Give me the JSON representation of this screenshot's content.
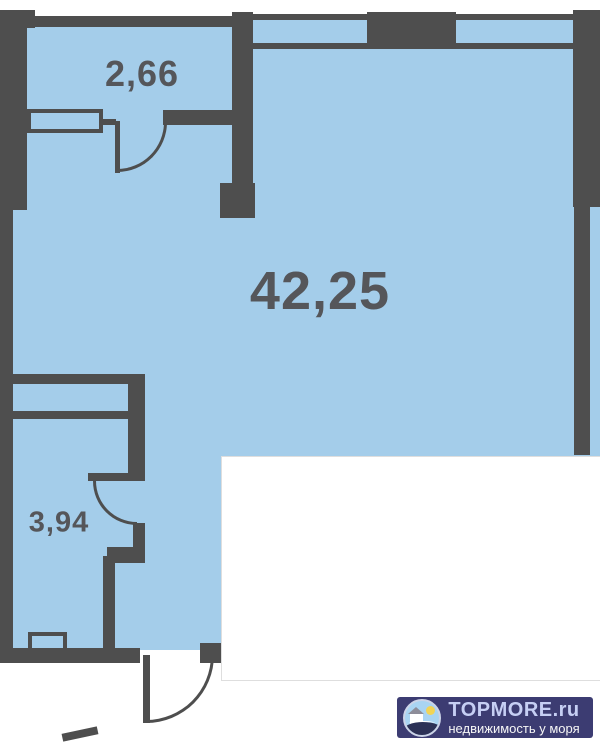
{
  "plan": {
    "type": "floor-plan",
    "rooms": [
      {
        "id": "entry-hall",
        "area_label": "2,66"
      },
      {
        "id": "main-room",
        "area_label": "42,25"
      },
      {
        "id": "bathroom",
        "area_label": "3,94"
      }
    ],
    "colors": {
      "floor": "#a4cdea",
      "wall": "#4e4e4e",
      "label_text": "#55565a"
    }
  },
  "watermark": {
    "brand": "TOPMORE.ru",
    "tagline": "недвижимость у моря",
    "colors": {
      "background": "#3c3c72",
      "brand_text": "#c6cff4",
      "tagline_text": "#f6f6f6"
    }
  }
}
